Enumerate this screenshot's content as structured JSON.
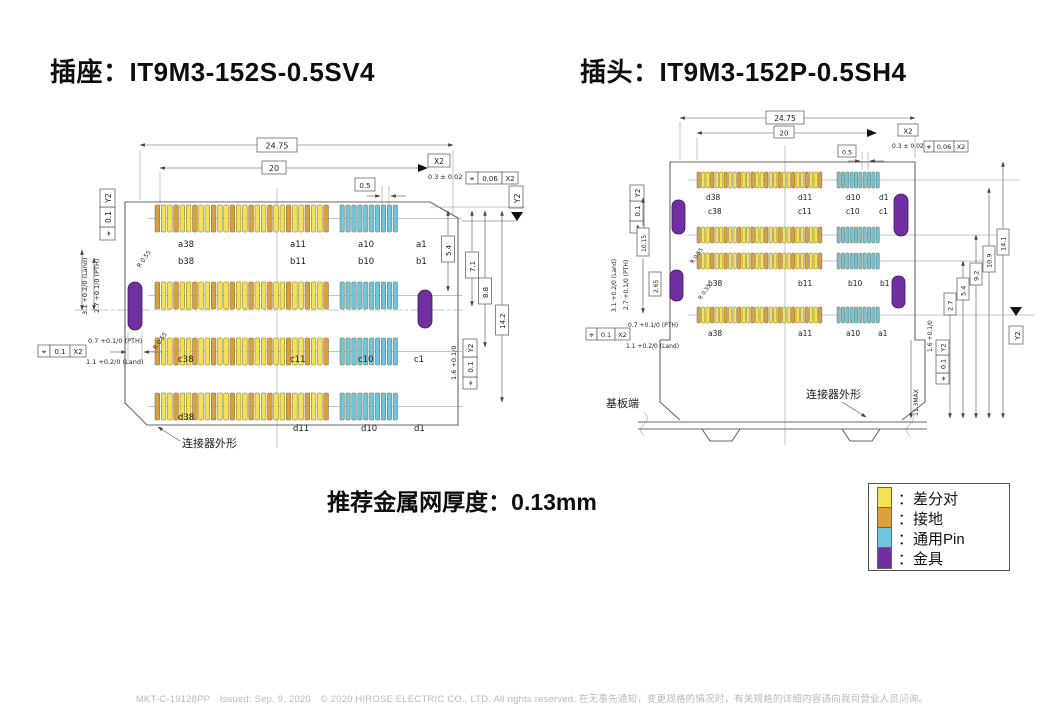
{
  "page": {
    "socket_title": "插座：IT9M3-152S-0.5SV4",
    "plug_title": "插头：IT9M3-152P-0.5SH4",
    "thickness_note": "推荐金属网厚度：0.13mm",
    "footer": "MKT-C-19128PP　Issued: Sep. 9, 2020　© 2020 HIROSE ELECTRIC CO., LTD. All rights reserved. 在无事先通知，变更规格的情况时，有关规格的详细内容请向我司营业人员问询。"
  },
  "colors": {
    "diff_pair": "#f2e254",
    "ground": "#dd9e3e",
    "general_pin": "#6fc4de",
    "fitting": "#7030a0"
  },
  "fcf_symbol": "⌖",
  "legend": {
    "items": [
      {
        "color_key": "diff_pair",
        "label": "：差分对"
      },
      {
        "color_key": "ground",
        "label": "：接地"
      },
      {
        "color_key": "general_pin",
        "label": "：通用Pin"
      },
      {
        "color_key": "fitting",
        "label": "：金具"
      }
    ]
  },
  "socket": {
    "dims": {
      "overall_width": "24.75",
      "span": "20",
      "datum_x2": "X2",
      "lead_tol": "0.3 ± 0.02",
      "pos_tol_top": "0.06",
      "pos_tol_top_datum": "X2",
      "datum_y2": "Y2",
      "lead_len": "0.5",
      "row_dim_1": "5.4",
      "row_dim_2": "7.1",
      "row_dim_3": "8.8",
      "row_dim_4": "14.2",
      "pad_len": "1.6 +0.1/0",
      "pos_tol_right": "0.1",
      "pos_tol_right_datum": "Y2",
      "fitting_land": "3.1 +0.2/0 (Land)",
      "fitting_pth": "2.7 +0.1/0 (PTH)",
      "fitting_r1": "R 0.55",
      "fitting_r2": "R 0.55",
      "pos_tol_left": "0.1",
      "pos_tol_left_datum": "Y2",
      "hole_pth": "0.7 +0.1/0 (PTH)",
      "hole_land": "1.1 +0.2/0 (Land)",
      "pos_tol_bottom": "0.1",
      "pos_tol_bottom_datum": "X2"
    },
    "pin_labels": {
      "a38": "a38",
      "b38": "b38",
      "c38": "c38",
      "d38": "d38",
      "a11": "a11",
      "b11": "b11",
      "c11": "c11",
      "d11": "d11",
      "a10": "a10",
      "b10": "b10",
      "c10": "c10",
      "d10": "d10",
      "a1": "a1",
      "b1": "b1",
      "c1": "c1",
      "d1": "d1"
    },
    "outline_label": "连接器外形"
  },
  "plug": {
    "dims": {
      "overall_width": "24.75",
      "span": "20",
      "datum_x2": "X2",
      "lead_tol": "0.3 ± 0.02",
      "pos_tol_top": "0.06",
      "pos_tol_top_datum": "X2",
      "lead_len": "0.5",
      "fitting_land": "3.1 +0.2/0 (Land)",
      "fitting_pth": "2.7 +0.1/0 (PTH)",
      "fitting_span": "10.15",
      "fitting_offset": "2.65",
      "fitting_r1": "R 0.55",
      "fitting_r2": "R 0.55",
      "pos_tol_left": "0.1",
      "pos_tol_left_datum": "Y2",
      "hole_pth": "0.7 +0.1/0 (PTH)",
      "hole_land": "1.1 +0.2/0 (Land)",
      "pos_tol_bottom": "0.1",
      "pos_tol_bottom_datum": "X2",
      "row_dim_1": "2.7",
      "row_dim_2": "5.4",
      "row_dim_3": "9.2",
      "row_dim_4": "10.9",
      "row_dim_5": "14.1",
      "height_max": "11.3MAX",
      "pad_len": "1.6 +0.1/0",
      "pos_tol_right": "0.1",
      "pos_tol_right_datum": "Y2",
      "datum_y2": "Y2"
    },
    "pin_labels": {
      "a38": "a38",
      "b38": "b38",
      "c38": "c38",
      "d38": "d38",
      "a11": "a11",
      "b11": "b11",
      "c11": "c11",
      "d11": "d11",
      "a10": "a10",
      "b10": "b10",
      "c10": "c10",
      "d10": "d10",
      "a1": "a1",
      "b1": "b1",
      "c1": "c1",
      "d1": "d1"
    },
    "board_label": "基板端",
    "outline_label": "连接器外形"
  }
}
